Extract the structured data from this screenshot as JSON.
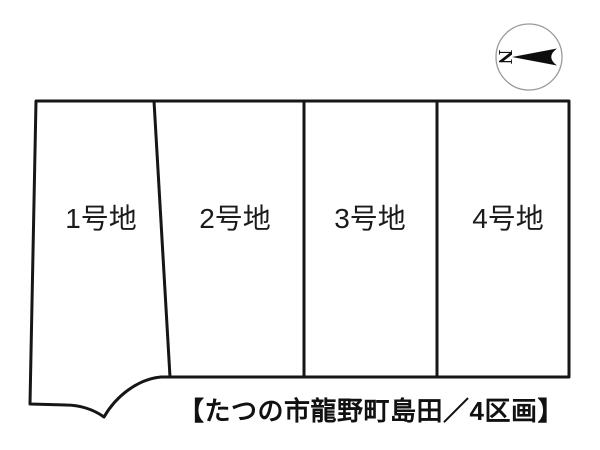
{
  "caption": "【たつの市龍野町島田／4区画】",
  "compass": {
    "label": "N",
    "arrow_points": "left"
  },
  "plots": [
    {
      "label": "1号地"
    },
    {
      "label": "2号地"
    },
    {
      "label": "3号地"
    },
    {
      "label": "4号地"
    }
  ],
  "colors": {
    "line": "#161616",
    "background": "#ffffff",
    "compass_ring": "#9a9a9a",
    "arrow_fill": "#0d0d0d"
  }
}
